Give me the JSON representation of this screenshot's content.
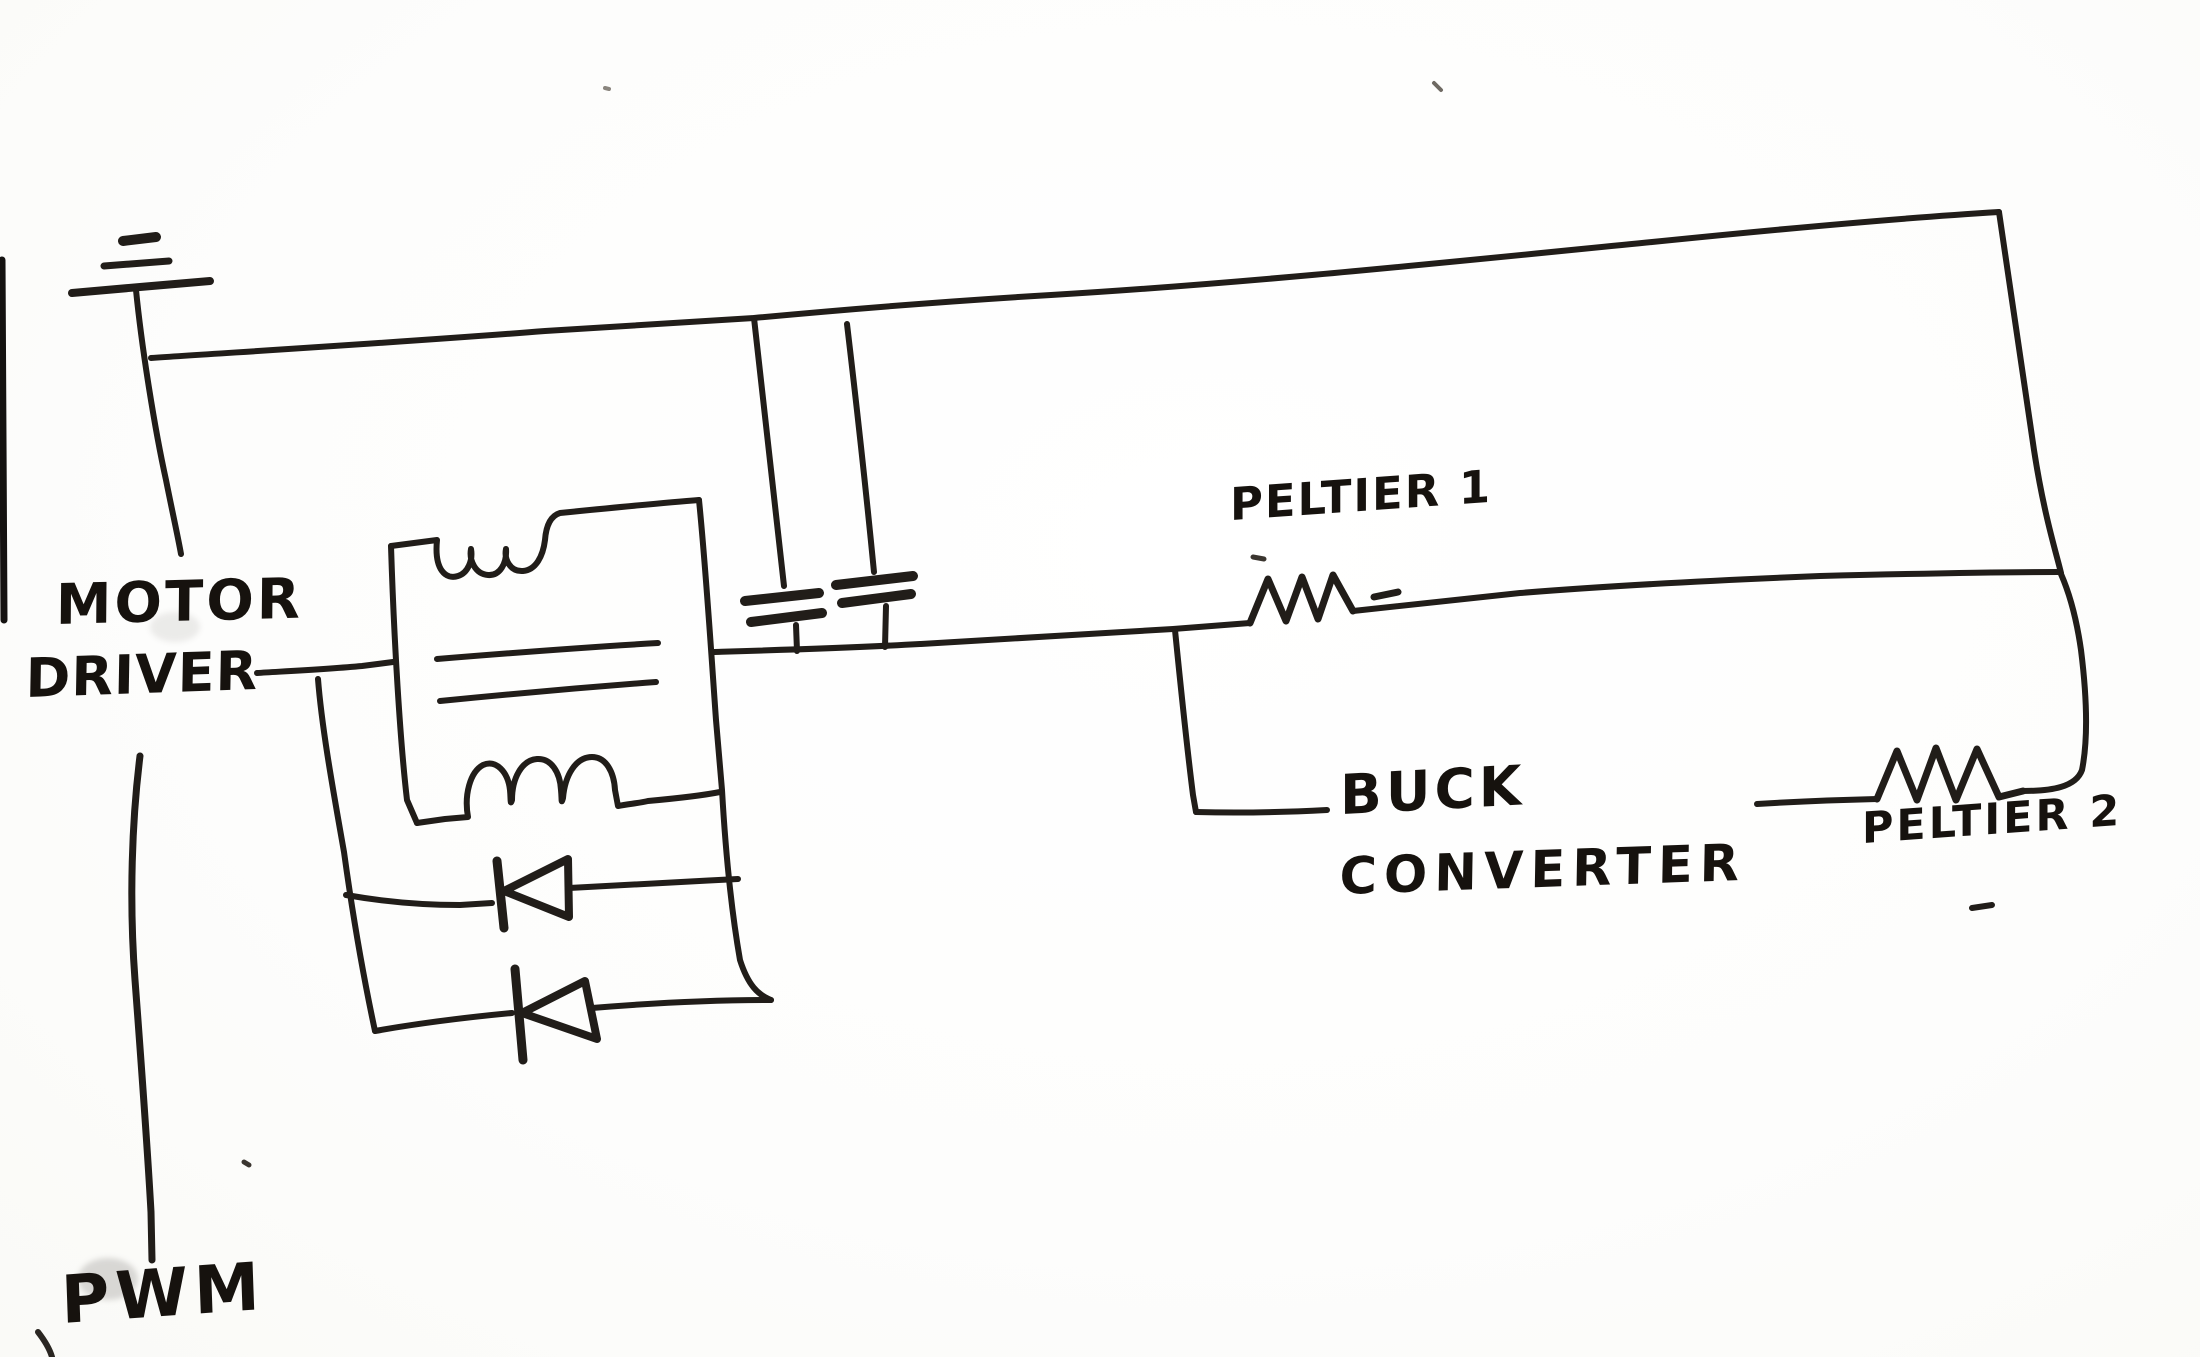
{
  "page": {
    "paper_color": "#fdfdfc",
    "ink_color": "#211d19"
  },
  "diagram": {
    "kind": "hand-drawn circuit schematic",
    "labels": {
      "motor_driver_line1": "MOTOR",
      "motor_driver_line2": "DRIVER",
      "pwm": "PWM",
      "peltier1": "PELTIER 1",
      "buck_line1": "BUCK",
      "buck_line2": "CONVERTER",
      "peltier2": "PELTIER 2"
    },
    "components": [
      {
        "name": "ground-symbol",
        "type": "ground"
      },
      {
        "name": "motor-winding-block",
        "type": "inductor-pair-box"
      },
      {
        "name": "flyback-diode-1",
        "type": "diode"
      },
      {
        "name": "flyback-diode-2",
        "type": "diode"
      },
      {
        "name": "filter-capacitor-1",
        "type": "capacitor"
      },
      {
        "name": "filter-capacitor-2",
        "type": "capacitor"
      },
      {
        "name": "peltier-1-element",
        "type": "resistor"
      },
      {
        "name": "peltier-2-element",
        "type": "resistor"
      }
    ]
  }
}
